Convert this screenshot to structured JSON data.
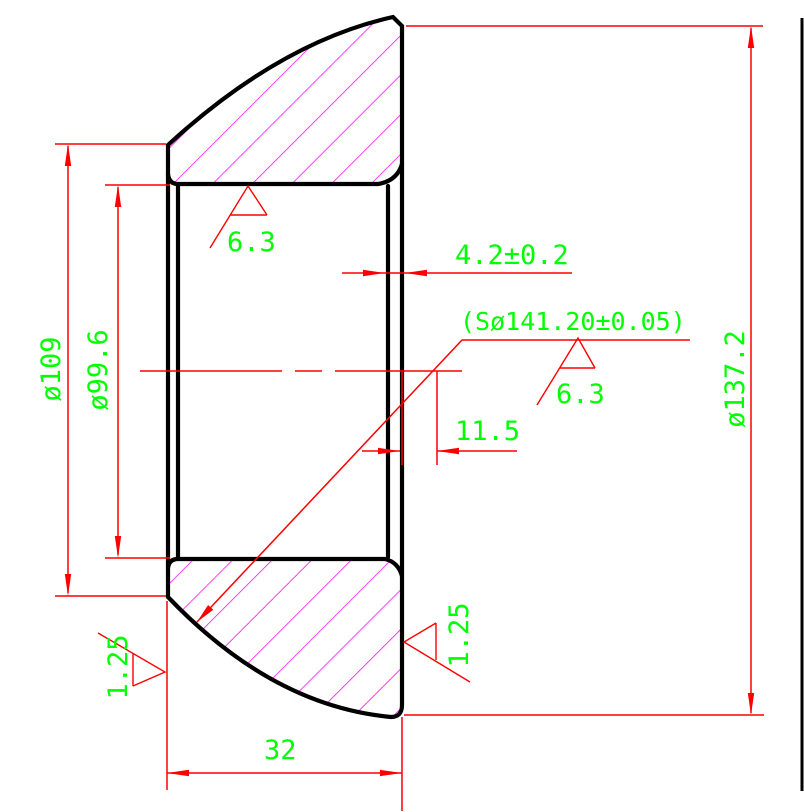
{
  "drawing": {
    "colors": {
      "outline": "#000000",
      "dimension_lines": "#ff0000",
      "dimension_text": "#00ff00",
      "hatch": "#ff00ff",
      "background": "#ffffff"
    },
    "labels": {
      "left_face_diameter": "ø109",
      "bore_diameter": "ø99.6",
      "outer_face_diameter": "ø137.2",
      "wall_thickness": "4.2±0.2",
      "sphere_diameter": "(Sø141.20±0.05)",
      "sphere_center_offset": "11.5",
      "part_width": "32",
      "roughness_bore": "6.3",
      "roughness_sphere": "6.3",
      "roughness_left_face": "1.25",
      "roughness_right_face": "1.25"
    }
  }
}
